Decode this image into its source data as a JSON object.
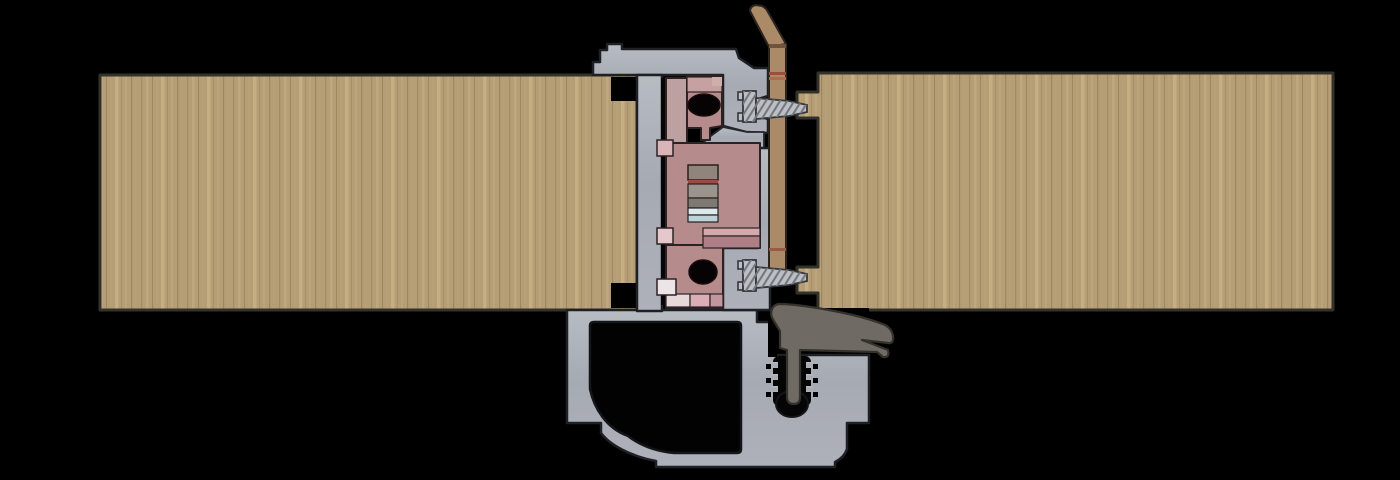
{
  "meta": {
    "title": "Partition frame cross-section",
    "view": "technical-section-render",
    "background": "#000000"
  },
  "components": {
    "left_panel": {
      "name": "left wood panel",
      "color": "#b59d76"
    },
    "right_panel": {
      "name": "right wood panel",
      "color": "#b59d76"
    },
    "frame_profile": {
      "name": "aluminium frame profile",
      "color": "#a9adb5"
    },
    "mechanism": {
      "name": "connector lock mechanism",
      "color": "#b68b8c"
    },
    "mechanism_light": {
      "name": "mechanism upper block",
      "color": "#c7a1a1"
    },
    "adjuster": {
      "name": "adjuster insert stack",
      "band_colors": [
        "#8f857c",
        "#9c4a42",
        "#9a948d",
        "#7e7972",
        "#dde9ed",
        "#bdd2d9"
      ]
    },
    "screws": {
      "name": "fixing screws",
      "count": 2,
      "color": "#bcc0c5",
      "thread_hatch": "#75797f"
    },
    "filler_strip": {
      "name": "timber filler strip",
      "color": "#aa8a67",
      "joint_color": "#9a4f3e"
    },
    "gasket": {
      "name": "rubber seal gasket",
      "color": "#6f6b64"
    },
    "holes": {
      "name": "section bores",
      "color": "#070203"
    },
    "hollow": {
      "name": "profile hollow chamber",
      "color": "#020202"
    }
  }
}
